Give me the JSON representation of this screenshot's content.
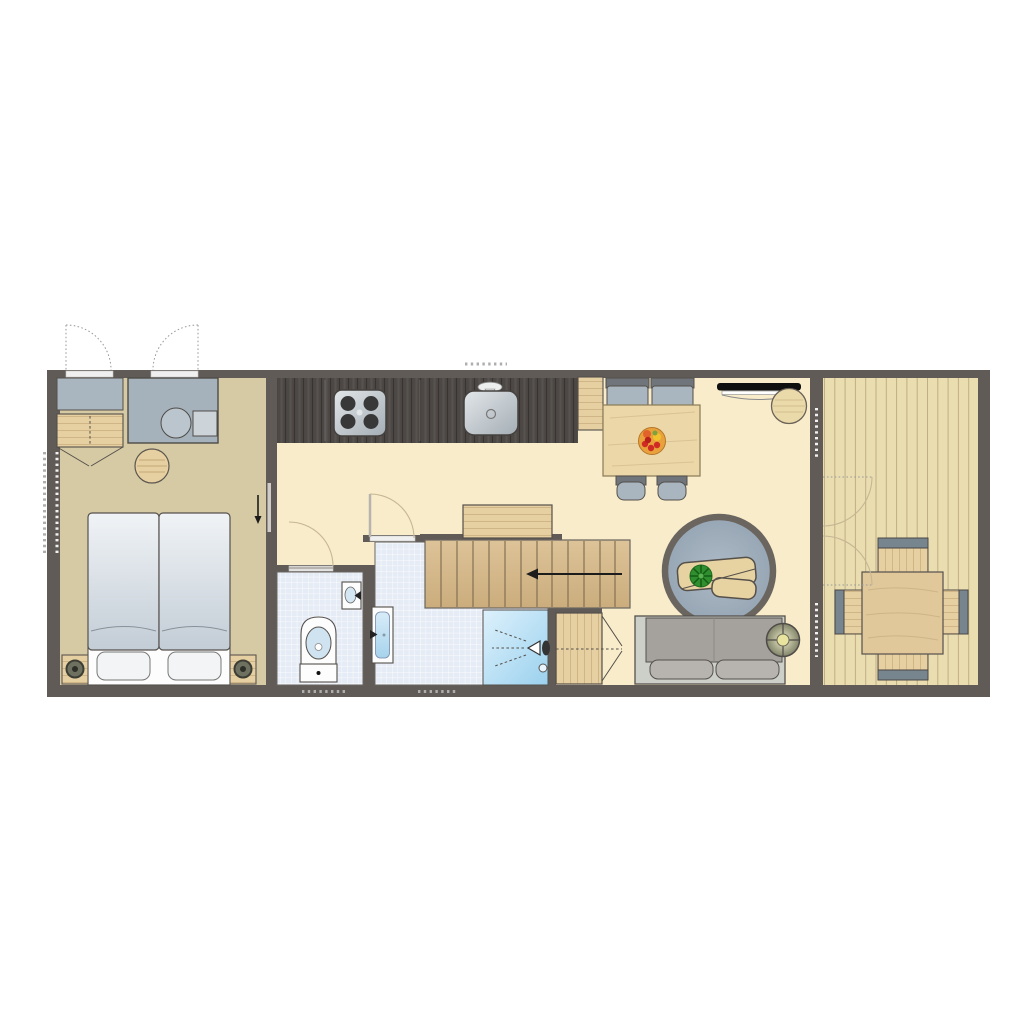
{
  "plan": {
    "kind": "floor-plan",
    "rooms": {
      "bedroom": {
        "floor": "khaki",
        "furniture": [
          "double-bed",
          "pillow-left",
          "pillow-right",
          "nightstand-left",
          "nightstand-right",
          "bedside-lamp-left",
          "bedside-lamp-right",
          "wardrobe",
          "vanity-unit",
          "vanity-basin",
          "cupboard",
          "round-stool",
          "sliding-door",
          "entry-door-left",
          "entry-door-right"
        ]
      },
      "kitchen": {
        "furniture": [
          "kitchen-counter",
          "hob-4-burners",
          "kitchen-sink",
          "faucet",
          "tall-cabinet"
        ]
      },
      "wc": {
        "floor": "tiles",
        "furniture": [
          "toilet",
          "corner-washbasin",
          "wc-door"
        ]
      },
      "bathroom": {
        "floor": "tiles",
        "furniture": [
          "washbasin",
          "shower",
          "shower-head",
          "shower-drain",
          "bathroom-door",
          "linen-closet"
        ]
      },
      "hall": {
        "furniture": [
          "staircase",
          "stairs-direction-arrow",
          "cabinet-by-stairs"
        ]
      },
      "living_room": {
        "furniture": [
          "dining-table",
          "fruit-bowl",
          "dining-chair-1",
          "dining-chair-2",
          "dining-chair-3",
          "dining-chair-4",
          "wall-tv",
          "side-pouf",
          "round-rug",
          "coffee-table",
          "plant",
          "sofa",
          "floor-lamp",
          "deck-double-doors"
        ]
      },
      "deck": {
        "floor": "wood-planks",
        "furniture": [
          "outdoor-table",
          "outdoor-chair-top",
          "outdoor-chair-bottom",
          "outdoor-chair-left",
          "outdoor-chair-right"
        ]
      }
    },
    "windows": [
      "left-wall-window",
      "kitchen-window",
      "wc-window",
      "bathroom-window",
      "deck-wall-window-upper",
      "deck-wall-window-lower"
    ]
  },
  "colors": {
    "wall": "#605b57",
    "outline": "#55504b",
    "bedroom_floor": "#d6caa4",
    "living_floor": "#f8ecca",
    "deck_floor": "#eaddb0",
    "tile": "#e6ecf5",
    "counter": "#4d4845",
    "wood": "#e6cfa0",
    "stairs_wood": "#d7bb8d",
    "gray_furniture": "#a9b5bf",
    "sofa_gray": "#a5a29d",
    "sofa_cushion": "#b7b4b0",
    "sofa_base": "#cdd0c8",
    "rug": "#a3b1bf",
    "shower_blue": "#aedcf2",
    "plant_green": "#2f8f2f",
    "door_arc": "#c6b694",
    "arrow": "#1c1c1c"
  }
}
